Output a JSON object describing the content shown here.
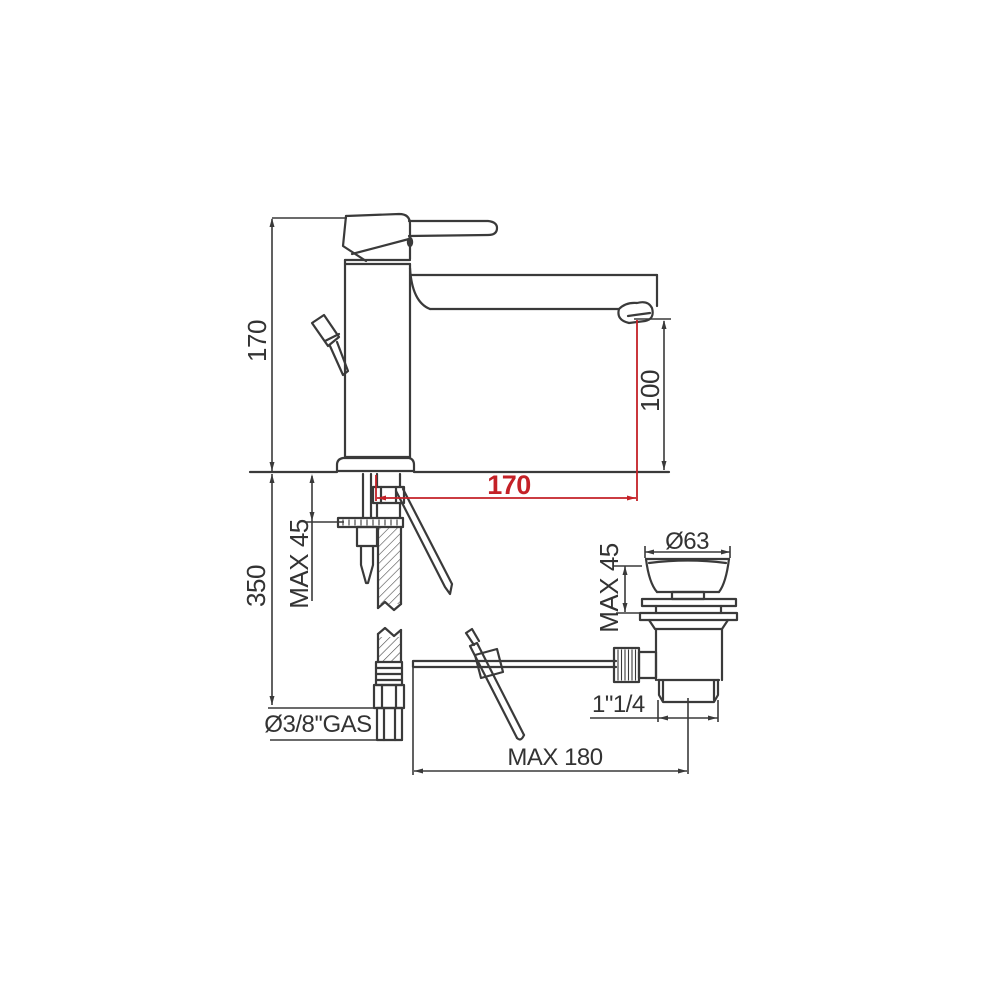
{
  "diagram": {
    "kind": "technical-drawing",
    "subject": "single-lever basin mixer tap with pop-up waste drain",
    "background_color": "#ffffff",
    "line_color": "#3a3a3a",
    "accent_color": "#c42127",
    "labels": {
      "total_height": "170",
      "hose_length": "350",
      "deck_thickness_max": "MAX 45",
      "supply_connection": "Ø3/8''GAS",
      "outlet_height": "100",
      "spout_reach": "170",
      "waste_flange_diameter": "Ø63",
      "waste_deck_thickness_max": "MAX 45",
      "waste_outlet_thread": "1\"1/4",
      "popup_rod_reach_max": "MAX 180"
    }
  }
}
